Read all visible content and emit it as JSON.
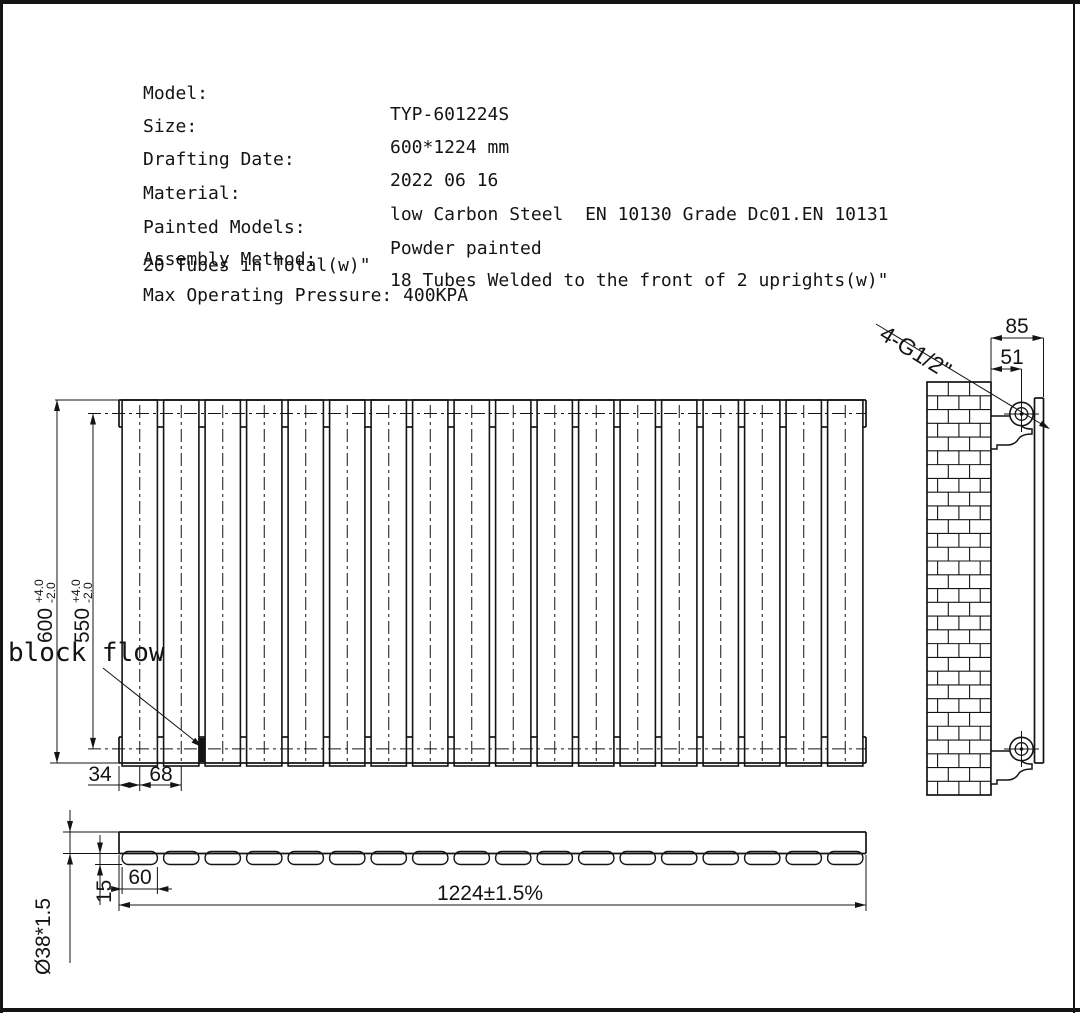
{
  "title_block": {
    "rows": [
      {
        "label": "Model:",
        "value": "TYP-601224S"
      },
      {
        "label": "Size:",
        "value": "600*1224 mm"
      },
      {
        "label": "Drafting Date:",
        "value": "2022 06 16"
      },
      {
        "label": "Material:",
        "value": "low Carbon Steel  EN 10130 Grade Dc01.EN 10131"
      },
      {
        "label": "Painted Models:",
        "value": "Powder painted"
      },
      {
        "label": "Assembly Method:",
        "value": "18 Tubes Welded to the front of 2 uprights(w)\""
      }
    ],
    "note_line": "20 Tubes in Total(w)\"",
    "pressure_line": "Max Operating Pressure: 400KPA"
  },
  "annotations": {
    "block_flow": "block flow",
    "connection_spec": "4-G1/2\""
  },
  "dimensions": {
    "front": {
      "overall_height": "600",
      "overall_height_tol_plus": "+4.0",
      "overall_height_tol_minus": "-2.0",
      "center_height": "550",
      "center_height_tol_plus": "+4.0",
      "center_height_tol_minus": "-2.0",
      "edge_to_first_tube": "34",
      "tube_pitch": "68"
    },
    "side": {
      "wall_to_front": "85",
      "wall_to_center": "51"
    },
    "bottom": {
      "upright_tube": "Ø38*1.5",
      "tube_depth": "15",
      "tube_width": "60",
      "overall_width": "1224±1.5%"
    }
  },
  "drawing": {
    "tube_count": 18,
    "colors": {
      "line": "#141414",
      "background": "#ffffff"
    }
  }
}
